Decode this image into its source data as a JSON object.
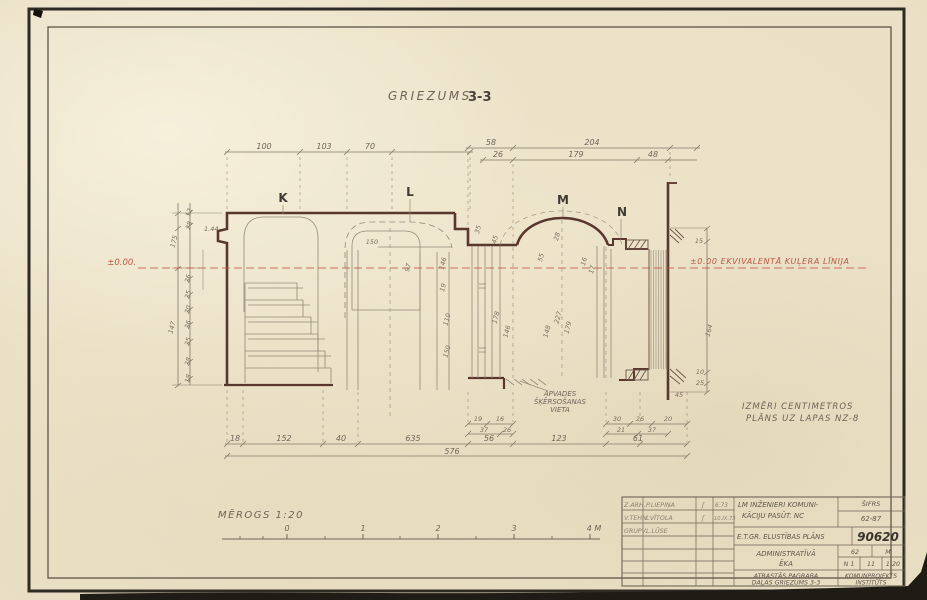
{
  "title": {
    "word": "GRIEZUMS",
    "num": "3-3"
  },
  "markers": [
    "K",
    "L",
    "M",
    "N"
  ],
  "level": {
    "left": "±0.00.",
    "right": "±0.00 EKVIVALENTĀ KUĻERA LĪNIJA"
  },
  "notes": {
    "l1": "APVADES",
    "l2": "ŠĶĒRSOŠANAS",
    "l3": "VIETA",
    "r1": "IZMĒRI CENTIMETROS",
    "r2": "PLĀNS UZ LAPAS NZ-8"
  },
  "scale": {
    "label": "MĒROGS 1:20",
    "ticks": [
      "0",
      "1",
      "2",
      "3",
      "4 M"
    ]
  },
  "dims": {
    "top1": [
      "100",
      "103",
      "70"
    ],
    "topr1": [
      "58",
      "204"
    ],
    "topr2": [
      "26",
      "179",
      "48"
    ],
    "botc1a": [
      "19",
      "16"
    ],
    "botc1b": [
      "37",
      "26"
    ],
    "botc2a": [
      "30",
      "26",
      "20"
    ],
    "botc2b": [
      "21",
      "37"
    ],
    "bot": [
      "18",
      "152",
      "40",
      "635",
      "56",
      "123",
      "61"
    ],
    "total": "576",
    "left_big": [
      "175",
      "147"
    ],
    "left_small": [
      "12",
      "28",
      "1.44",
      "26",
      "25",
      "20",
      "26",
      "25",
      "28",
      "18"
    ],
    "right": [
      "15",
      "164",
      "10",
      "25",
      "45"
    ],
    "inner": [
      "150",
      "97",
      "146",
      "19",
      "110",
      "150",
      "35",
      "45",
      "178",
      "146",
      "148",
      "227",
      "179",
      "28",
      "55",
      "16",
      "17"
    ]
  },
  "titleblock": {
    "r1c1": "LM INŽENIERI KOMUNI-",
    "r1c1b": "KĀCIJU PASŪT. NC",
    "sifrs": "ŠIFRS",
    "sifrs_v": "62-87",
    "r2": "E.T.GR. ELUSTĪBAS PLĀNS",
    "num": "90620",
    "r3a": "ADMINISTRATĪVĀ",
    "r3b": "ĒKA",
    "c62": "62",
    "cM": "M",
    "cn1": "N 1",
    "c11": "11",
    "c120": "1:20",
    "r4a": "ATRASTĀS PAGRABA",
    "r4b": "DAĻAS GRIEZUMS 3-3",
    "org1": "KOMUNPROJEKTS",
    "org2": "INSTITŪTS",
    "rows": [
      [
        "Z.ARH.",
        "P.LIEPIŅA",
        "ʃ",
        "6.73"
      ],
      [
        "V.TEHN.",
        "I.VĪTOLA",
        "ʃ",
        "10.IX.73"
      ],
      [
        "GRUPV.",
        "L.LŪSE",
        "",
        ""
      ]
    ]
  }
}
